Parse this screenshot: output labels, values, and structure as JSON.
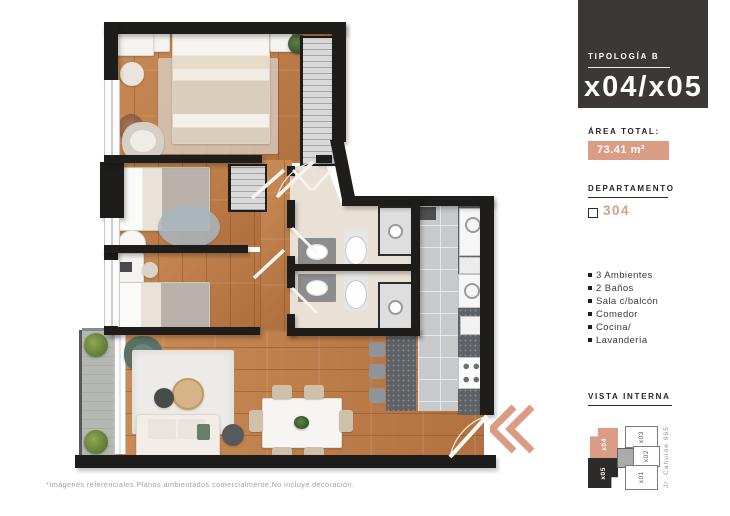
{
  "colors": {
    "accent": "#DA9C84",
    "panel_dark": "#3B3836"
  },
  "panel": {
    "tipologia_label": "TIPOLOGÍA B",
    "tipologia_units": "x04/x05",
    "area_label": "ÁREA TOTAL:",
    "area_value": "73.41 m²",
    "departamento_label": "DEPARTAMENTO",
    "departamento_value": "304",
    "features": [
      "3 Ambientes",
      "2 Baños",
      "Sala c/balcón",
      "Comedor",
      "Cocina/",
      "Lavandería"
    ],
    "vista_interna_label": "VISTA INTERNA",
    "minimap": {
      "street": "Jr. Cahuide 965",
      "highlighted_unit": "x04",
      "dark_unit": "x05",
      "other_units": [
        "x03",
        "x02",
        "x01"
      ]
    }
  },
  "floorplan": {
    "footnote": "*Imágenes referenciales.Planos ambientados comercialmente.No incluye decoración."
  }
}
